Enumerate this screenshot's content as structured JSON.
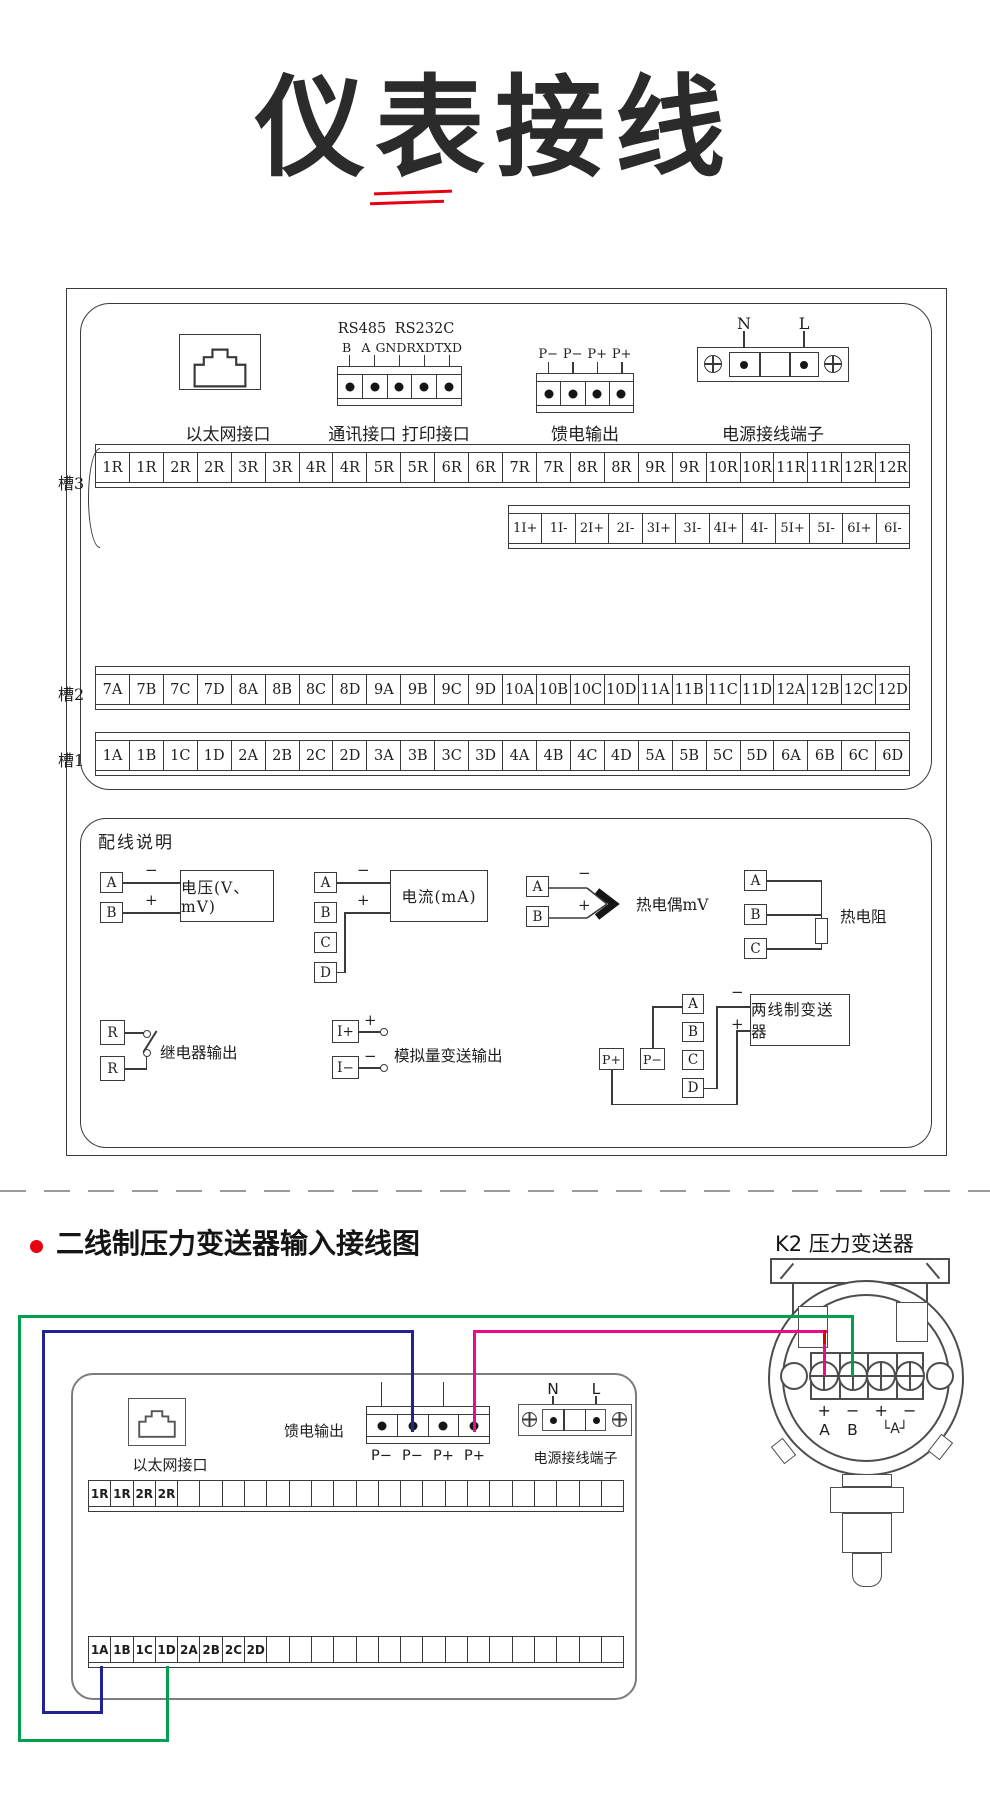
{
  "title": "仪表接线",
  "colors": {
    "accent_red": "#e60012",
    "wire_green": "#00a04e",
    "wire_blue": "#23238f",
    "wire_pink": "#ec0a8c",
    "wire_red": "#e60000",
    "line": "#3a3a3a"
  },
  "top": {
    "ethernet_label": "以太网接口",
    "comm_group1": "RS485",
    "comm_group2": "RS232C",
    "comm_pins": [
      "B",
      "A",
      "GND",
      "RXD",
      "TXD"
    ],
    "comm_label": "通讯接口  打印接口",
    "feed_pins": [
      "P−",
      "P−",
      "P+",
      "P+"
    ],
    "feed_label": "馈电输出",
    "power_n": "N",
    "power_l": "L",
    "power_label": "电源接线端子"
  },
  "slots": {
    "slot3_label": "槽3",
    "slot3_cells": [
      "1R",
      "1R",
      "2R",
      "2R",
      "3R",
      "3R",
      "4R",
      "4R",
      "5R",
      "5R",
      "6R",
      "6R",
      "7R",
      "7R",
      "8R",
      "8R",
      "9R",
      "9R",
      "10R",
      "10R",
      "11R",
      "11R",
      "12R",
      "12R"
    ],
    "slot3_sub_cells": [
      "1I+",
      "1I-",
      "2I+",
      "2I-",
      "3I+",
      "3I-",
      "4I+",
      "4I-",
      "5I+",
      "5I-",
      "6I+",
      "6I-"
    ],
    "slot2_label": "槽2",
    "slot2_cells": [
      "7A",
      "7B",
      "7C",
      "7D",
      "8A",
      "8B",
      "8C",
      "8D",
      "9A",
      "9B",
      "9C",
      "9D",
      "10A",
      "10B",
      "10C",
      "10D",
      "11A",
      "11B",
      "11C",
      "11D",
      "12A",
      "12B",
      "12C",
      "12D"
    ],
    "slot1_label": "槽1",
    "slot1_cells": [
      "1A",
      "1B",
      "1C",
      "1D",
      "2A",
      "2B",
      "2C",
      "2D",
      "3A",
      "3B",
      "3C",
      "3D",
      "4A",
      "4B",
      "4C",
      "4D",
      "5A",
      "5B",
      "5C",
      "5D",
      "6A",
      "6B",
      "6C",
      "6D"
    ]
  },
  "notes": {
    "title": "配线说明",
    "plus": "+",
    "minus": "−",
    "voltage_a": "A",
    "voltage_b": "B",
    "voltage_device": "电压(V、mV)",
    "current_a": "A",
    "current_b": "B",
    "current_c": "C",
    "current_d": "D",
    "current_device": "电流(mA)",
    "tc_a": "A",
    "tc_b": "B",
    "tc_label": "热电偶mV",
    "rtd_a": "A",
    "rtd_b": "B",
    "rtd_c": "C",
    "rtd_label": "热电阻",
    "relay_r1": "R",
    "relay_r2": "R",
    "relay_label": "继电器输出",
    "an_ip": "I+",
    "an_im": "I−",
    "an_label": "模拟量变送输出",
    "tw_a": "A",
    "tw_b": "B",
    "tw_c": "C",
    "tw_d": "D",
    "tw_pp": "P+",
    "tw_pm": "P−",
    "tw_device": "两线制变送器"
  },
  "bottom": {
    "section_title": "二线制压力变送器输入接线图",
    "k2_label": "K2 压力变送器",
    "ethernet_label": "以太网接口",
    "feed_label": "馈电输出",
    "feed_pins": [
      "P−",
      "P−",
      "P+",
      "P+"
    ],
    "power_n": "N",
    "power_l": "L",
    "power_label": "电源接线端子",
    "strip_total": 24,
    "strip_top_cells": [
      "1R",
      "1R",
      "2R",
      "2R"
    ],
    "strip_bottom_cells": [
      "1A",
      "1B",
      "1C",
      "1D",
      "2A",
      "2B",
      "2C",
      "2D"
    ],
    "tx_signs": [
      "+",
      "−",
      "+",
      "−"
    ],
    "tx_a": "A",
    "tx_b": "B",
    "tx_bracket": "└A┘"
  }
}
